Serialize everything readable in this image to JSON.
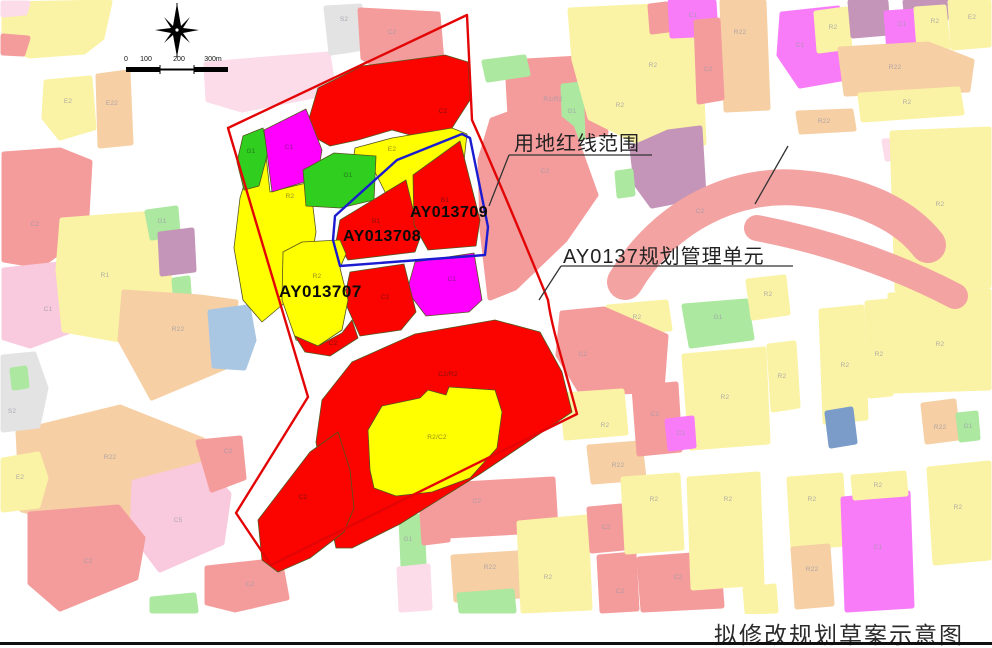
{
  "caption": "拟修改规划草案示意图",
  "annotations": {
    "red_line_label": "用地红线范围",
    "unit_label": "AY0137规划管理单元",
    "parcel_left_id": "AY013707",
    "parcel_mid_id": "AY013708",
    "parcel_right_id": "AY013709"
  },
  "colors": {
    "unit_boundary_red": "#e30505",
    "red_line_blue": "#1b1bd0",
    "bright_red": "#fb0400",
    "bright_yellow": "#ffff00",
    "bright_green": "#2fce1f",
    "bright_magenta": "#ff00ff"
  },
  "scale_ticks": [
    {
      "t": "0",
      "x": 126
    },
    {
      "t": "100",
      "x": 146
    },
    {
      "t": "200",
      "x": 179
    },
    {
      "t": "300m",
      "x": 213
    }
  ],
  "map_labels": [
    {
      "t": "E2",
      "x": 68,
      "y": 102,
      "c": "ctx"
    },
    {
      "t": "E22",
      "x": 112,
      "y": 104,
      "c": "ctx"
    },
    {
      "t": "C2",
      "x": 35,
      "y": 225,
      "c": "ctx"
    },
    {
      "t": "C1",
      "x": 48,
      "y": 310,
      "c": "ctx"
    },
    {
      "t": "R1",
      "x": 105,
      "y": 276,
      "c": "ctx"
    },
    {
      "t": "G1",
      "x": 162,
      "y": 222,
      "c": "ctx"
    },
    {
      "t": "R22",
      "x": 178,
      "y": 330,
      "c": "ctx"
    },
    {
      "t": "R22",
      "x": 110,
      "y": 458,
      "c": "ctx"
    },
    {
      "t": "S2",
      "x": 12,
      "y": 412,
      "c": "ctx"
    },
    {
      "t": "E2",
      "x": 20,
      "y": 478,
      "c": "ctx"
    },
    {
      "t": "C5",
      "x": 178,
      "y": 521,
      "c": "ctx"
    },
    {
      "t": "C2",
      "x": 88,
      "y": 562,
      "c": "ctx"
    },
    {
      "t": "C2",
      "x": 228,
      "y": 452,
      "c": "ctx"
    },
    {
      "t": "C2",
      "x": 250,
      "y": 585,
      "c": "ctx"
    },
    {
      "t": "S2",
      "x": 344,
      "y": 20,
      "c": "ctx"
    },
    {
      "t": "C2",
      "x": 392,
      "y": 33,
      "c": "ctx"
    },
    {
      "t": "R1/R2",
      "x": 553,
      "y": 100,
      "c": "ctx"
    },
    {
      "t": "G1",
      "x": 572,
      "y": 112,
      "c": "ctx"
    },
    {
      "t": "R2",
      "x": 653,
      "y": 66,
      "c": "ctx"
    },
    {
      "t": "R2",
      "x": 620,
      "y": 106,
      "c": "ctx"
    },
    {
      "t": "C1",
      "x": 693,
      "y": 16,
      "c": "ctx"
    },
    {
      "t": "R22",
      "x": 740,
      "y": 33,
      "c": "ctx"
    },
    {
      "t": "C2",
      "x": 708,
      "y": 70,
      "c": "ctx"
    },
    {
      "t": "C1",
      "x": 800,
      "y": 46,
      "c": "ctx"
    },
    {
      "t": "R2",
      "x": 833,
      "y": 28,
      "c": "ctx"
    },
    {
      "t": "C1",
      "x": 902,
      "y": 25,
      "c": "ctx"
    },
    {
      "t": "R2",
      "x": 935,
      "y": 22,
      "c": "ctx"
    },
    {
      "t": "E2",
      "x": 972,
      "y": 18,
      "c": "ctx"
    },
    {
      "t": "R22",
      "x": 895,
      "y": 68,
      "c": "ctx"
    },
    {
      "t": "R2",
      "x": 907,
      "y": 103,
      "c": "ctx"
    },
    {
      "t": "R22",
      "x": 824,
      "y": 122,
      "c": "ctx"
    },
    {
      "t": "C2",
      "x": 545,
      "y": 172,
      "c": "ctx"
    },
    {
      "t": "C2",
      "x": 700,
      "y": 212,
      "c": "ctx"
    },
    {
      "t": "R2",
      "x": 637,
      "y": 318,
      "c": "ctx"
    },
    {
      "t": "C2",
      "x": 583,
      "y": 355,
      "c": "ctx"
    },
    {
      "t": "G1",
      "x": 718,
      "y": 318,
      "c": "ctx"
    },
    {
      "t": "R2",
      "x": 768,
      "y": 295,
      "c": "ctx"
    },
    {
      "t": "R2",
      "x": 725,
      "y": 398,
      "c": "ctx"
    },
    {
      "t": "R2",
      "x": 782,
      "y": 377,
      "c": "ctx"
    },
    {
      "t": "R2",
      "x": 845,
      "y": 366,
      "c": "ctx"
    },
    {
      "t": "R2",
      "x": 879,
      "y": 355,
      "c": "ctx"
    },
    {
      "t": "R2",
      "x": 940,
      "y": 205,
      "c": "ctx"
    },
    {
      "t": "R2",
      "x": 940,
      "y": 345,
      "c": "ctx"
    },
    {
      "t": "R22",
      "x": 940,
      "y": 428,
      "c": "ctx"
    },
    {
      "t": "G1",
      "x": 968,
      "y": 427,
      "c": "ctx"
    },
    {
      "t": "R2",
      "x": 605,
      "y": 426,
      "c": "ctx"
    },
    {
      "t": "R22",
      "x": 618,
      "y": 466,
      "c": "ctx"
    },
    {
      "t": "C2",
      "x": 655,
      "y": 415,
      "c": "ctx"
    },
    {
      "t": "C1",
      "x": 681,
      "y": 434,
      "c": "ctx"
    },
    {
      "t": "G1",
      "x": 408,
      "y": 540,
      "c": "ctx"
    },
    {
      "t": "C2",
      "x": 477,
      "y": 502,
      "c": "ctx"
    },
    {
      "t": "R22",
      "x": 490,
      "y": 568,
      "c": "ctx"
    },
    {
      "t": "R2",
      "x": 548,
      "y": 578,
      "c": "ctx"
    },
    {
      "t": "C2",
      "x": 606,
      "y": 528,
      "c": "ctx"
    },
    {
      "t": "C2",
      "x": 620,
      "y": 592,
      "c": "ctx"
    },
    {
      "t": "R2",
      "x": 654,
      "y": 500,
      "c": "ctx"
    },
    {
      "t": "C2",
      "x": 678,
      "y": 578,
      "c": "ctx"
    },
    {
      "t": "R2",
      "x": 728,
      "y": 500,
      "c": "ctx"
    },
    {
      "t": "R2",
      "x": 812,
      "y": 500,
      "c": "ctx"
    },
    {
      "t": "R22",
      "x": 812,
      "y": 570,
      "c": "ctx"
    },
    {
      "t": "C1",
      "x": 878,
      "y": 548,
      "c": "ctx"
    },
    {
      "t": "R2",
      "x": 878,
      "y": 486,
      "c": "ctx"
    },
    {
      "t": "R2",
      "x": 958,
      "y": 508,
      "c": "ctx"
    },
    {
      "t": "C2",
      "x": 443,
      "y": 112,
      "c": "red"
    },
    {
      "t": "G1",
      "x": 251,
      "y": 152,
      "c": "grn"
    },
    {
      "t": "C1",
      "x": 289,
      "y": 148,
      "c": "mag"
    },
    {
      "t": "R2",
      "x": 290,
      "y": 197,
      "c": "yel"
    },
    {
      "t": "E2",
      "x": 392,
      "y": 150,
      "c": "yel"
    },
    {
      "t": "G1",
      "x": 348,
      "y": 176,
      "c": "grn"
    },
    {
      "t": "B1",
      "x": 376,
      "y": 222,
      "c": "red"
    },
    {
      "t": "B1",
      "x": 445,
      "y": 201,
      "c": "red"
    },
    {
      "t": "C1",
      "x": 452,
      "y": 280,
      "c": "mag"
    },
    {
      "t": "C2",
      "x": 385,
      "y": 298,
      "c": "red"
    },
    {
      "t": "R2",
      "x": 317,
      "y": 277,
      "c": "yel"
    },
    {
      "t": "C2",
      "x": 333,
      "y": 344,
      "c": "red"
    },
    {
      "t": "C2/R2",
      "x": 448,
      "y": 375,
      "c": "red"
    },
    {
      "t": "R2/C2",
      "x": 437,
      "y": 438,
      "c": "yel"
    },
    {
      "t": "C2",
      "x": 303,
      "y": 498,
      "c": "red"
    }
  ]
}
